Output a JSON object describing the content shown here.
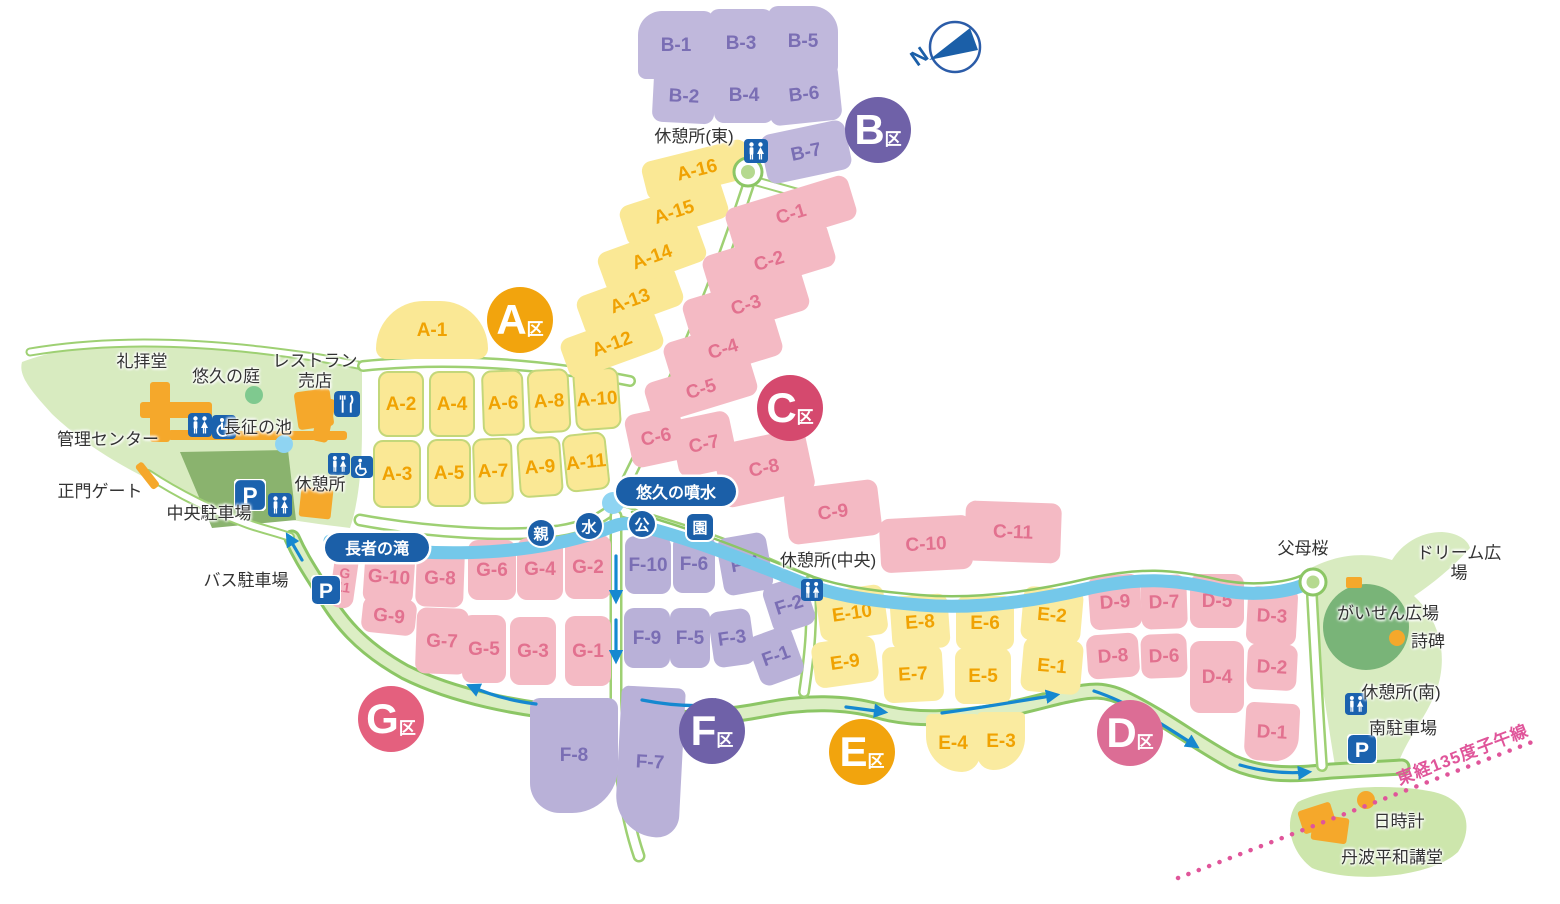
{
  "compass": {
    "label": "N"
  },
  "meridian": {
    "label": "東経135度子午線",
    "color": "#E0559A"
  },
  "colors": {
    "background": "#FFFFFF",
    "green_area": "#D8EBC0",
    "plaza_circle_green": "#79B478",
    "parking_area_green": "#8AB36E",
    "road_edge_green": "#8CC665",
    "loop_road_fill": "#DCEEC4",
    "river_blue": "#74C8EA",
    "arrow_blue": "#1588D0",
    "icon_blue": "#1B62AE",
    "label_oval_blue": "#1B5FA8",
    "building_orange": "#F5A82B",
    "meridian_pink": "#E0559A"
  },
  "zones": [
    {
      "id": "A",
      "badge": {
        "letter": "A",
        "suffix": "区",
        "x": 520,
        "y": 320,
        "color": "#F2A40D"
      },
      "fill": "#FAE895",
      "label_color": "#F0A202",
      "plots": [
        {
          "label": "A-1",
          "x": 432,
          "y": 330,
          "w": 112,
          "h": 58,
          "rot": 0,
          "radius": "56px 56px 12px 12px"
        },
        {
          "label": "A-2",
          "x": 401,
          "y": 404,
          "w": 46,
          "h": 66,
          "rot": 0,
          "edge": true
        },
        {
          "label": "A-4",
          "x": 452,
          "y": 404,
          "w": 46,
          "h": 66,
          "rot": 0,
          "edge": true
        },
        {
          "label": "A-6",
          "x": 503,
          "y": 403,
          "w": 42,
          "h": 66,
          "rot": -2,
          "edge": true
        },
        {
          "label": "A-8",
          "x": 549,
          "y": 401,
          "w": 42,
          "h": 64,
          "rot": -3,
          "edge": true
        },
        {
          "label": "A-10",
          "x": 597,
          "y": 399,
          "w": 46,
          "h": 62,
          "rot": -4,
          "edge": true
        },
        {
          "label": "A-3",
          "x": 397,
          "y": 474,
          "w": 48,
          "h": 68,
          "rot": 0,
          "edge": true
        },
        {
          "label": "A-5",
          "x": 449,
          "y": 473,
          "w": 44,
          "h": 68,
          "rot": 0,
          "edge": true
        },
        {
          "label": "A-7",
          "x": 493,
          "y": 471,
          "w": 40,
          "h": 66,
          "rot": -2,
          "edge": true
        },
        {
          "label": "A-9",
          "x": 540,
          "y": 467,
          "w": 44,
          "h": 60,
          "rot": -4,
          "edge": true
        },
        {
          "label": "A-11",
          "x": 586,
          "y": 462,
          "w": 44,
          "h": 58,
          "rot": -6,
          "edge": true
        },
        {
          "label": "A-12",
          "x": 612,
          "y": 344,
          "w": 100,
          "h": 42,
          "rot": -20
        },
        {
          "label": "A-13",
          "x": 630,
          "y": 301,
          "w": 104,
          "h": 42,
          "rot": -20
        },
        {
          "label": "A-14",
          "x": 652,
          "y": 257,
          "w": 106,
          "h": 42,
          "rot": -20
        },
        {
          "label": "A-15",
          "x": 674,
          "y": 212,
          "w": 106,
          "h": 42,
          "rot": -18
        },
        {
          "label": "A-16",
          "x": 697,
          "y": 170,
          "w": 108,
          "h": 40,
          "rot": -14
        }
      ]
    },
    {
      "id": "B",
      "badge": {
        "letter": "B",
        "suffix": "区",
        "x": 878,
        "y": 130,
        "color": "#6F61A8"
      },
      "fill": "#C0B8DC",
      "label_color": "#7A6EB4",
      "plots": [
        {
          "label": "B-1",
          "x": 676,
          "y": 45,
          "w": 76,
          "h": 68,
          "rot": 0,
          "radius": "24px 10px 8px 8px"
        },
        {
          "label": "B-3",
          "x": 741,
          "y": 43,
          "w": 64,
          "h": 68,
          "rot": 0
        },
        {
          "label": "B-5",
          "x": 803,
          "y": 41,
          "w": 70,
          "h": 70,
          "rot": 0,
          "radius": "10px 26px 10px 10px"
        },
        {
          "label": "B-2",
          "x": 684,
          "y": 96,
          "w": 62,
          "h": 54,
          "rot": 3
        },
        {
          "label": "B-4",
          "x": 744,
          "y": 95,
          "w": 60,
          "h": 56,
          "rot": 0
        },
        {
          "label": "B-6",
          "x": 804,
          "y": 94,
          "w": 72,
          "h": 58,
          "rot": -6
        },
        {
          "label": "B-7",
          "x": 806,
          "y": 152,
          "w": 86,
          "h": 50,
          "rot": -12
        }
      ]
    },
    {
      "id": "C",
      "badge": {
        "letter": "C",
        "suffix": "区",
        "x": 790,
        "y": 408,
        "color": "#D5496E"
      },
      "fill": "#F4BAC4",
      "label_color": "#E2718F",
      "plots": [
        {
          "label": "C-1",
          "x": 791,
          "y": 214,
          "w": 128,
          "h": 46,
          "rot": -17
        },
        {
          "label": "C-2",
          "x": 769,
          "y": 261,
          "w": 130,
          "h": 46,
          "rot": -17
        },
        {
          "label": "C-3",
          "x": 746,
          "y": 305,
          "w": 124,
          "h": 44,
          "rot": -17
        },
        {
          "label": "C-4",
          "x": 723,
          "y": 349,
          "w": 116,
          "h": 44,
          "rot": -17
        },
        {
          "label": "C-5",
          "x": 701,
          "y": 389,
          "w": 110,
          "h": 42,
          "rot": -17
        },
        {
          "label": "C-6",
          "x": 656,
          "y": 437,
          "w": 56,
          "h": 54,
          "rot": -12
        },
        {
          "label": "C-7",
          "x": 704,
          "y": 444,
          "w": 60,
          "h": 58,
          "rot": -12
        },
        {
          "label": "C-8",
          "x": 764,
          "y": 468,
          "w": 94,
          "h": 64,
          "rot": -12
        },
        {
          "label": "C-9",
          "x": 833,
          "y": 512,
          "w": 94,
          "h": 56,
          "rot": -7
        },
        {
          "label": "C-10",
          "x": 926,
          "y": 544,
          "w": 92,
          "h": 54,
          "rot": -3
        },
        {
          "label": "C-11",
          "x": 1013,
          "y": 532,
          "w": 96,
          "h": 60,
          "rot": 2
        }
      ]
    },
    {
      "id": "D",
      "badge": {
        "letter": "D",
        "suffix": "区",
        "x": 1130,
        "y": 733,
        "color": "#DC6D95"
      },
      "fill": "#F4BAC4",
      "label_color": "#E2718F",
      "plots": [
        {
          "label": "D-9",
          "x": 1115,
          "y": 602,
          "w": 52,
          "h": 54,
          "rot": -4
        },
        {
          "label": "D-7",
          "x": 1164,
          "y": 602,
          "w": 46,
          "h": 54,
          "rot": -2
        },
        {
          "label": "D-5",
          "x": 1217,
          "y": 601,
          "w": 54,
          "h": 54,
          "rot": 0
        },
        {
          "label": "D-3",
          "x": 1272,
          "y": 616,
          "w": 50,
          "h": 58,
          "rot": 3
        },
        {
          "label": "D-8",
          "x": 1113,
          "y": 656,
          "w": 52,
          "h": 44,
          "rot": -4
        },
        {
          "label": "D-6",
          "x": 1164,
          "y": 656,
          "w": 46,
          "h": 44,
          "rot": -2
        },
        {
          "label": "D-4",
          "x": 1217,
          "y": 677,
          "w": 54,
          "h": 72,
          "rot": 0
        },
        {
          "label": "D-2",
          "x": 1272,
          "y": 667,
          "w": 50,
          "h": 46,
          "rot": 3
        },
        {
          "label": "D-1",
          "x": 1272,
          "y": 732,
          "w": 54,
          "h": 58,
          "rot": 3,
          "radius": "8px 8px 24px 14px"
        }
      ]
    },
    {
      "id": "E",
      "badge": {
        "letter": "E",
        "suffix": "区",
        "x": 862,
        "y": 752,
        "color": "#F2A40D"
      },
      "fill": "#FAEBA0",
      "label_color": "#F0A202",
      "plots": [
        {
          "label": "E-10",
          "x": 852,
          "y": 613,
          "w": 68,
          "h": 50,
          "rot": -8
        },
        {
          "label": "E-8",
          "x": 920,
          "y": 622,
          "w": 58,
          "h": 54,
          "rot": -4
        },
        {
          "label": "E-6",
          "x": 985,
          "y": 623,
          "w": 58,
          "h": 54,
          "rot": 0
        },
        {
          "label": "E-2",
          "x": 1052,
          "y": 615,
          "w": 60,
          "h": 54,
          "rot": 5
        },
        {
          "label": "E-9",
          "x": 845,
          "y": 662,
          "w": 64,
          "h": 46,
          "rot": -8
        },
        {
          "label": "E-7",
          "x": 913,
          "y": 674,
          "w": 60,
          "h": 56,
          "rot": -3
        },
        {
          "label": "E-5",
          "x": 983,
          "y": 676,
          "w": 56,
          "h": 56,
          "rot": 0
        },
        {
          "label": "E-1",
          "x": 1052,
          "y": 666,
          "w": 60,
          "h": 54,
          "rot": 5
        },
        {
          "label": "E-4",
          "x": 953,
          "y": 743,
          "w": 54,
          "h": 58,
          "rot": 0,
          "radius": "6px 6px 20px 40px"
        },
        {
          "label": "E-3",
          "x": 1001,
          "y": 741,
          "w": 48,
          "h": 58,
          "rot": 0,
          "radius": "6px 6px 40px 20px"
        }
      ]
    },
    {
      "id": "F",
      "badge": {
        "letter": "F",
        "suffix": "区",
        "x": 712,
        "y": 731,
        "color": "#6F61A8"
      },
      "fill": "#B9B1D8",
      "label_color": "#7A6EB4",
      "plots": [
        {
          "label": "F-10",
          "x": 648,
          "y": 565,
          "w": 46,
          "h": 58,
          "rot": 0
        },
        {
          "label": "F-6",
          "x": 694,
          "y": 564,
          "w": 42,
          "h": 58,
          "rot": 0
        },
        {
          "label": "F-4",
          "x": 745,
          "y": 564,
          "w": 50,
          "h": 58,
          "rot": -10
        },
        {
          "label": "F-2",
          "x": 789,
          "y": 605,
          "w": 44,
          "h": 50,
          "rot": -18
        },
        {
          "label": "F-9",
          "x": 647,
          "y": 638,
          "w": 46,
          "h": 60,
          "rot": 0
        },
        {
          "label": "F-5",
          "x": 690,
          "y": 638,
          "w": 40,
          "h": 60,
          "rot": 0
        },
        {
          "label": "F-3",
          "x": 732,
          "y": 638,
          "w": 42,
          "h": 56,
          "rot": -8
        },
        {
          "label": "F-1",
          "x": 776,
          "y": 656,
          "w": 46,
          "h": 52,
          "rot": -20
        },
        {
          "label": "F-8",
          "x": 574,
          "y": 755,
          "w": 88,
          "h": 115,
          "rot": 0,
          "radius": "10px 10px 46px 30px"
        },
        {
          "label": "F-7",
          "x": 650,
          "y": 762,
          "w": 64,
          "h": 150,
          "rot": 3,
          "radius": "10px 10px 30px 56px"
        }
      ]
    },
    {
      "id": "G",
      "badge": {
        "letter": "G",
        "suffix": "区",
        "x": 391,
        "y": 719,
        "color": "#E4607E"
      },
      "fill": "#F4BAC4",
      "label_color": "#E2718F",
      "plots": [
        {
          "label": "G-11",
          "x": 344,
          "y": 580,
          "w": 24,
          "h": 56,
          "rot": 8,
          "stack": true,
          "fs": 14
        },
        {
          "label": "G-10",
          "x": 389,
          "y": 577,
          "w": 50,
          "h": 54,
          "rot": 4
        },
        {
          "label": "G-8",
          "x": 440,
          "y": 578,
          "w": 48,
          "h": 58,
          "rot": 2
        },
        {
          "label": "G-6",
          "x": 492,
          "y": 570,
          "w": 48,
          "h": 60,
          "rot": 0
        },
        {
          "label": "G-4",
          "x": 540,
          "y": 569,
          "w": 46,
          "h": 62,
          "rot": 0
        },
        {
          "label": "G-2",
          "x": 588,
          "y": 567,
          "w": 46,
          "h": 64,
          "rot": 0
        },
        {
          "label": "G-9",
          "x": 389,
          "y": 616,
          "w": 54,
          "h": 36,
          "rot": 6
        },
        {
          "label": "G-7",
          "x": 442,
          "y": 641,
          "w": 52,
          "h": 66,
          "rot": 2
        },
        {
          "label": "G-5",
          "x": 484,
          "y": 649,
          "w": 44,
          "h": 68,
          "rot": 0
        },
        {
          "label": "G-3",
          "x": 533,
          "y": 651,
          "w": 46,
          "h": 68,
          "rot": 0
        },
        {
          "label": "G-1",
          "x": 588,
          "y": 651,
          "w": 46,
          "h": 70,
          "rot": 0
        }
      ]
    }
  ],
  "facility_labels": [
    {
      "name": "worship-hall-label",
      "label": "礼拝堂",
      "x": 142,
      "y": 362
    },
    {
      "name": "yukyu-garden-label",
      "label": "悠久の庭",
      "x": 226,
      "y": 377
    },
    {
      "name": "restaurant-shop-label",
      "label": "レストラン\n売店",
      "x": 315,
      "y": 371
    },
    {
      "name": "admin-center-label",
      "label": "管理センター",
      "x": 108,
      "y": 440
    },
    {
      "name": "chosei-pond-label",
      "label": "長征の池",
      "x": 258,
      "y": 428
    },
    {
      "name": "main-gate-label",
      "label": "正門ゲート",
      "x": 100,
      "y": 492
    },
    {
      "name": "central-parking-label",
      "label": "中央駐車場",
      "x": 209,
      "y": 514
    },
    {
      "name": "rest-area-label",
      "label": "休憩所",
      "x": 320,
      "y": 485
    },
    {
      "name": "bus-parking-label",
      "label": "バス駐車場",
      "x": 246,
      "y": 581
    },
    {
      "name": "rest-area-east-label",
      "label": "休憩所(東)",
      "x": 694,
      "y": 137
    },
    {
      "name": "rest-area-central-label",
      "label": "休憩所(中央)",
      "x": 828,
      "y": 561
    },
    {
      "name": "fubo-sakura-label",
      "label": "父母桜",
      "x": 1303,
      "y": 549
    },
    {
      "name": "dream-plaza-label",
      "label": "ドリーム広場",
      "x": 1459,
      "y": 563
    },
    {
      "name": "gaisen-plaza-label",
      "label": "がいせん広場",
      "x": 1388,
      "y": 614
    },
    {
      "name": "poem-monument-label",
      "label": "詩碑",
      "x": 1428,
      "y": 642
    },
    {
      "name": "rest-area-south-label",
      "label": "休憩所(南)",
      "x": 1401,
      "y": 693
    },
    {
      "name": "south-parking-label",
      "label": "南駐車場",
      "x": 1403,
      "y": 729
    },
    {
      "name": "sundial-label",
      "label": "日時計",
      "x": 1399,
      "y": 822
    },
    {
      "name": "peace-hall-label",
      "label": "丹波平和講堂",
      "x": 1392,
      "y": 858
    }
  ],
  "map_icons": [
    {
      "name": "toilet",
      "x": 744,
      "y": 139,
      "size": 24
    },
    {
      "name": "toilet",
      "x": 188,
      "y": 413,
      "size": 24
    },
    {
      "name": "wheelchair",
      "x": 212,
      "y": 415,
      "size": 24
    },
    {
      "name": "toilet",
      "x": 328,
      "y": 453,
      "size": 22
    },
    {
      "name": "wheelchair",
      "x": 351,
      "y": 456,
      "size": 22
    },
    {
      "name": "parking",
      "x": 234,
      "y": 479,
      "size": 32
    },
    {
      "name": "toilet",
      "x": 268,
      "y": 493,
      "size": 24
    },
    {
      "name": "parking",
      "x": 311,
      "y": 575,
      "size": 30
    },
    {
      "name": "toilet",
      "x": 801,
      "y": 579,
      "size": 22
    },
    {
      "name": "toilet",
      "x": 1345,
      "y": 693,
      "size": 22
    },
    {
      "name": "parking",
      "x": 1347,
      "y": 734,
      "size": 30
    },
    {
      "name": "restaurant",
      "x": 334,
      "y": 391,
      "size": 26
    }
  ],
  "water_labels": [
    {
      "name": "choja-falls-label",
      "label": "長者の滝",
      "x": 377,
      "y": 547,
      "w": 104,
      "h": 29
    },
    {
      "name": "yukyu-fountain-label",
      "label": "悠久の噴水",
      "x": 676,
      "y": 491,
      "w": 120,
      "h": 29
    }
  ],
  "park_name_chars": [
    {
      "char": "親",
      "x": 541,
      "y": 533,
      "shape": "circle"
    },
    {
      "char": "水",
      "x": 589,
      "y": 526,
      "shape": "circle"
    },
    {
      "char": "公",
      "x": 642,
      "y": 524,
      "shape": "circle"
    },
    {
      "char": "園",
      "x": 700,
      "y": 527,
      "shape": "square"
    }
  ]
}
